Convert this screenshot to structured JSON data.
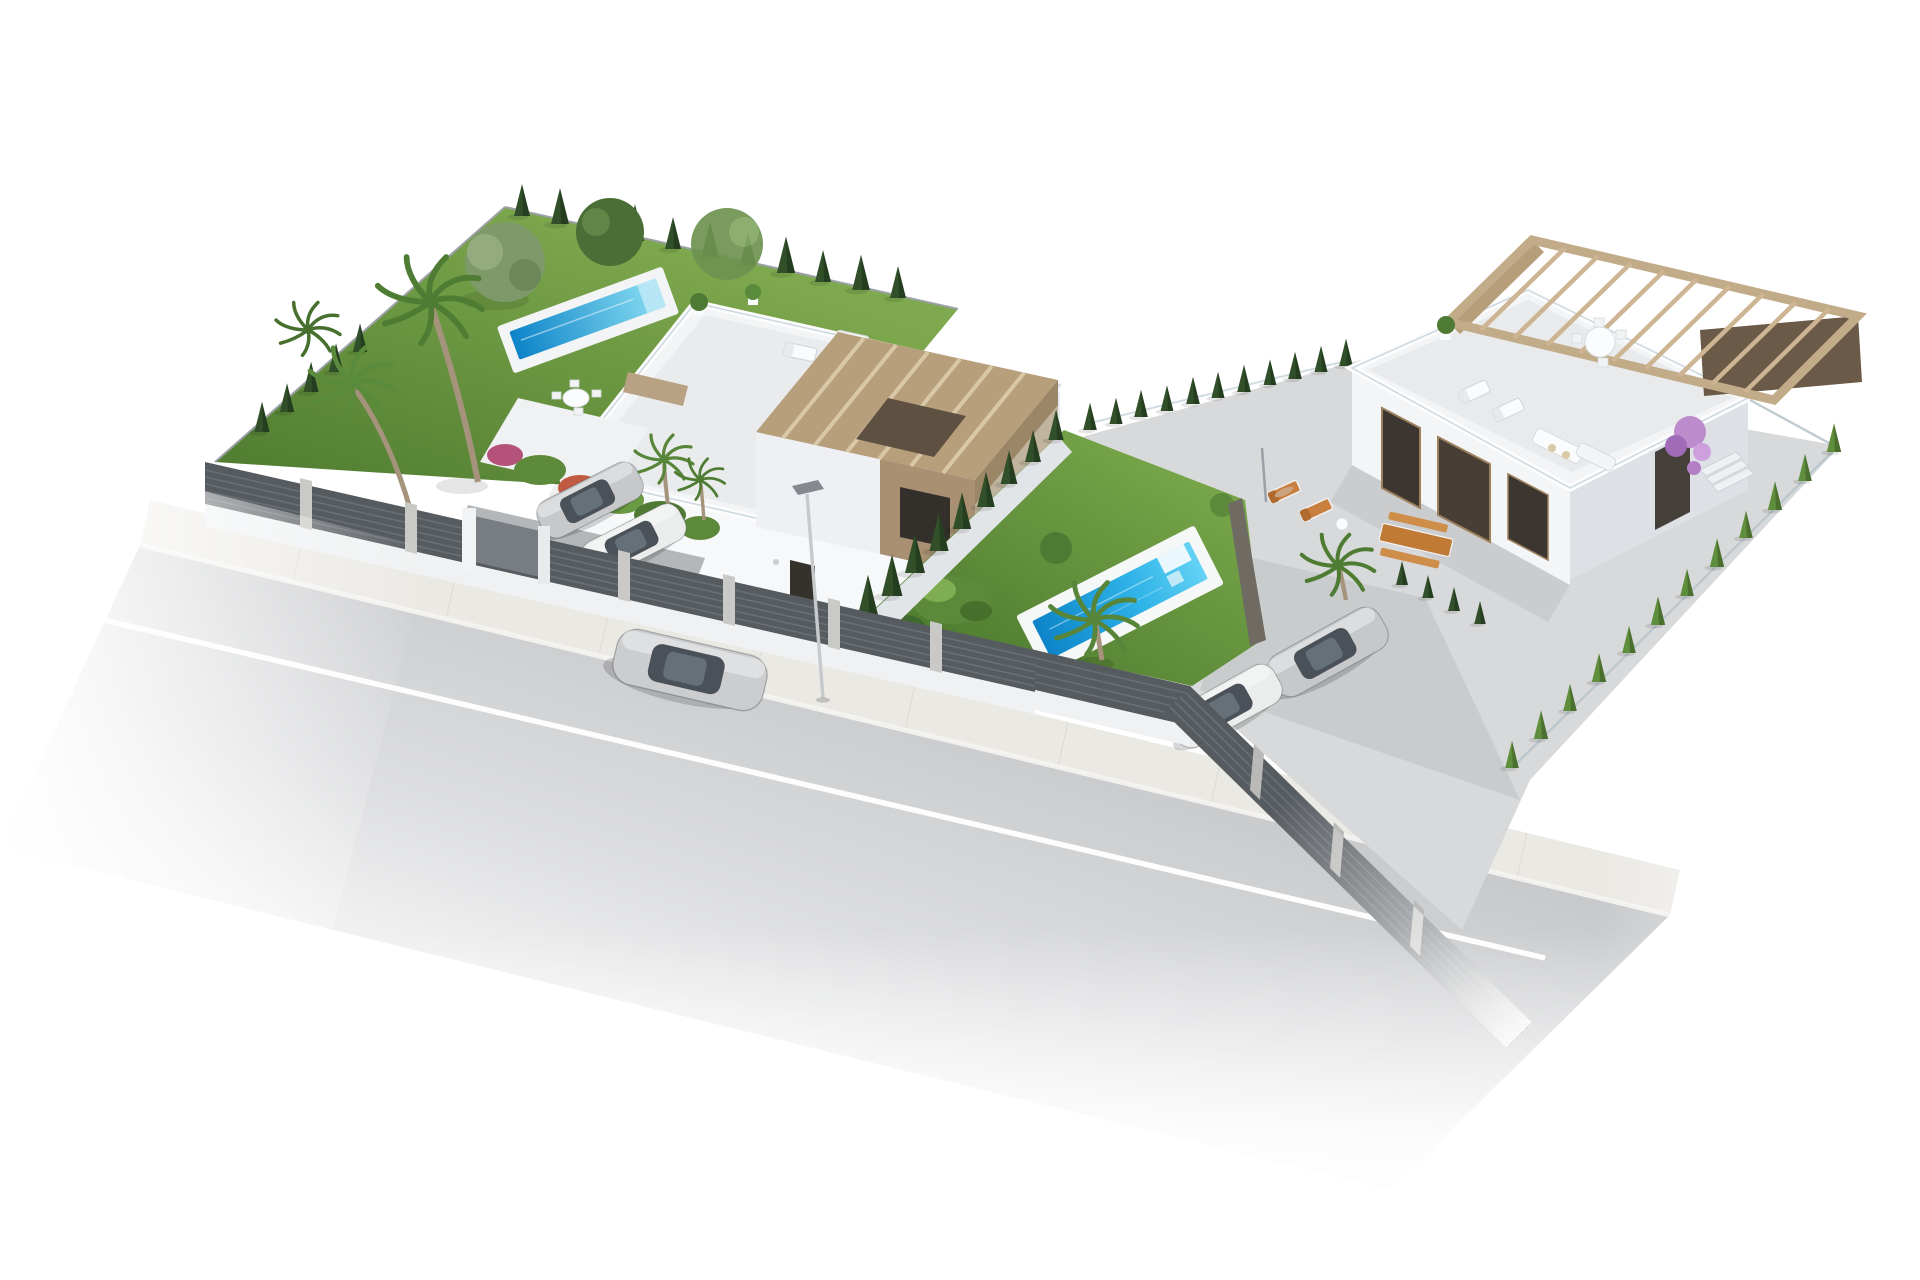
{
  "scene": {
    "description": "Aerial 3D architectural render of two modern white villas on an L-shaped corner plot with gardens, swimming pools, cypress hedges, parked cars and a street with a silver sedan driving by, isolated on a white background",
    "background": "#ffffff",
    "palette": {
      "lawn": "#6f9c42",
      "lawn_dark": "#4e7a31",
      "cypress": "#31502a",
      "hedge_light": "#5f8f3c",
      "palm_green": "#4f7c33",
      "pool_deep": "#0d84c8",
      "pool_bright": "#64d2f4",
      "road": "#c7c9cb",
      "sidewalk": "#ebe9e4",
      "fence_dark": "#565b60",
      "fence_light": "#82888d",
      "wall_white": "#f4f5f6",
      "wall_shadow": "#dde1e6",
      "accent_beige": "#b59d80",
      "pergola_wood": "#c2ab88",
      "dark_wood": "#6b5a47",
      "window_dark": "#35322c",
      "furniture_wood": "#c9803f",
      "car_silver": "#c6c8ca",
      "car_white": "#ebecec",
      "bougainvillea": "#bd8ccd",
      "lamp_gray": "#9aa0a5",
      "trunk": "#a5937c"
    },
    "elements": [
      {
        "id": "road",
        "label": "Asphalt street with white center line fading into white background"
      },
      {
        "id": "sidewalk",
        "label": "Paved sidewalk strip along the plots"
      },
      {
        "id": "left-villa",
        "label": "Two-storey white villa with roof terrace, sun loungers and beige pergola tower"
      },
      {
        "id": "left-garden",
        "label": "Lawn garden with elongated pool, olive tree, palms and cypress hedge"
      },
      {
        "id": "corner-garden",
        "label": "Corner lawn with rectangular turquoise pool, steps and palm tree"
      },
      {
        "id": "right-villa",
        "label": "Single-storey villa with large roof terrace, wooden pergola and dark timber doors"
      },
      {
        "id": "right-terrace",
        "label": "Paved terrace with orange sun loungers, sunbather and picnic table"
      },
      {
        "id": "street-lamp",
        "label": "Street lamp on the sidewalk"
      },
      {
        "id": "privacy-fence",
        "label": "Dark grey slatted privacy fence with concrete posts"
      },
      {
        "id": "hedges",
        "label": "Cypress hedge rows along the plot boundaries"
      }
    ],
    "vehicles": [
      {
        "type": "sedan",
        "color": "silver",
        "location": "driving on street"
      },
      {
        "type": "sedan",
        "color": "silver",
        "location": "left driveway"
      },
      {
        "type": "sedan",
        "color": "white",
        "location": "left driveway"
      },
      {
        "type": "sedan",
        "color": "silver",
        "location": "right driveway"
      },
      {
        "type": "sedan",
        "color": "white",
        "location": "right driveway"
      }
    ],
    "pools": [
      {
        "location": "left garden",
        "shape": "elongated lap pool"
      },
      {
        "location": "corner garden",
        "shape": "rectangular pool with white steps"
      }
    ]
  }
}
